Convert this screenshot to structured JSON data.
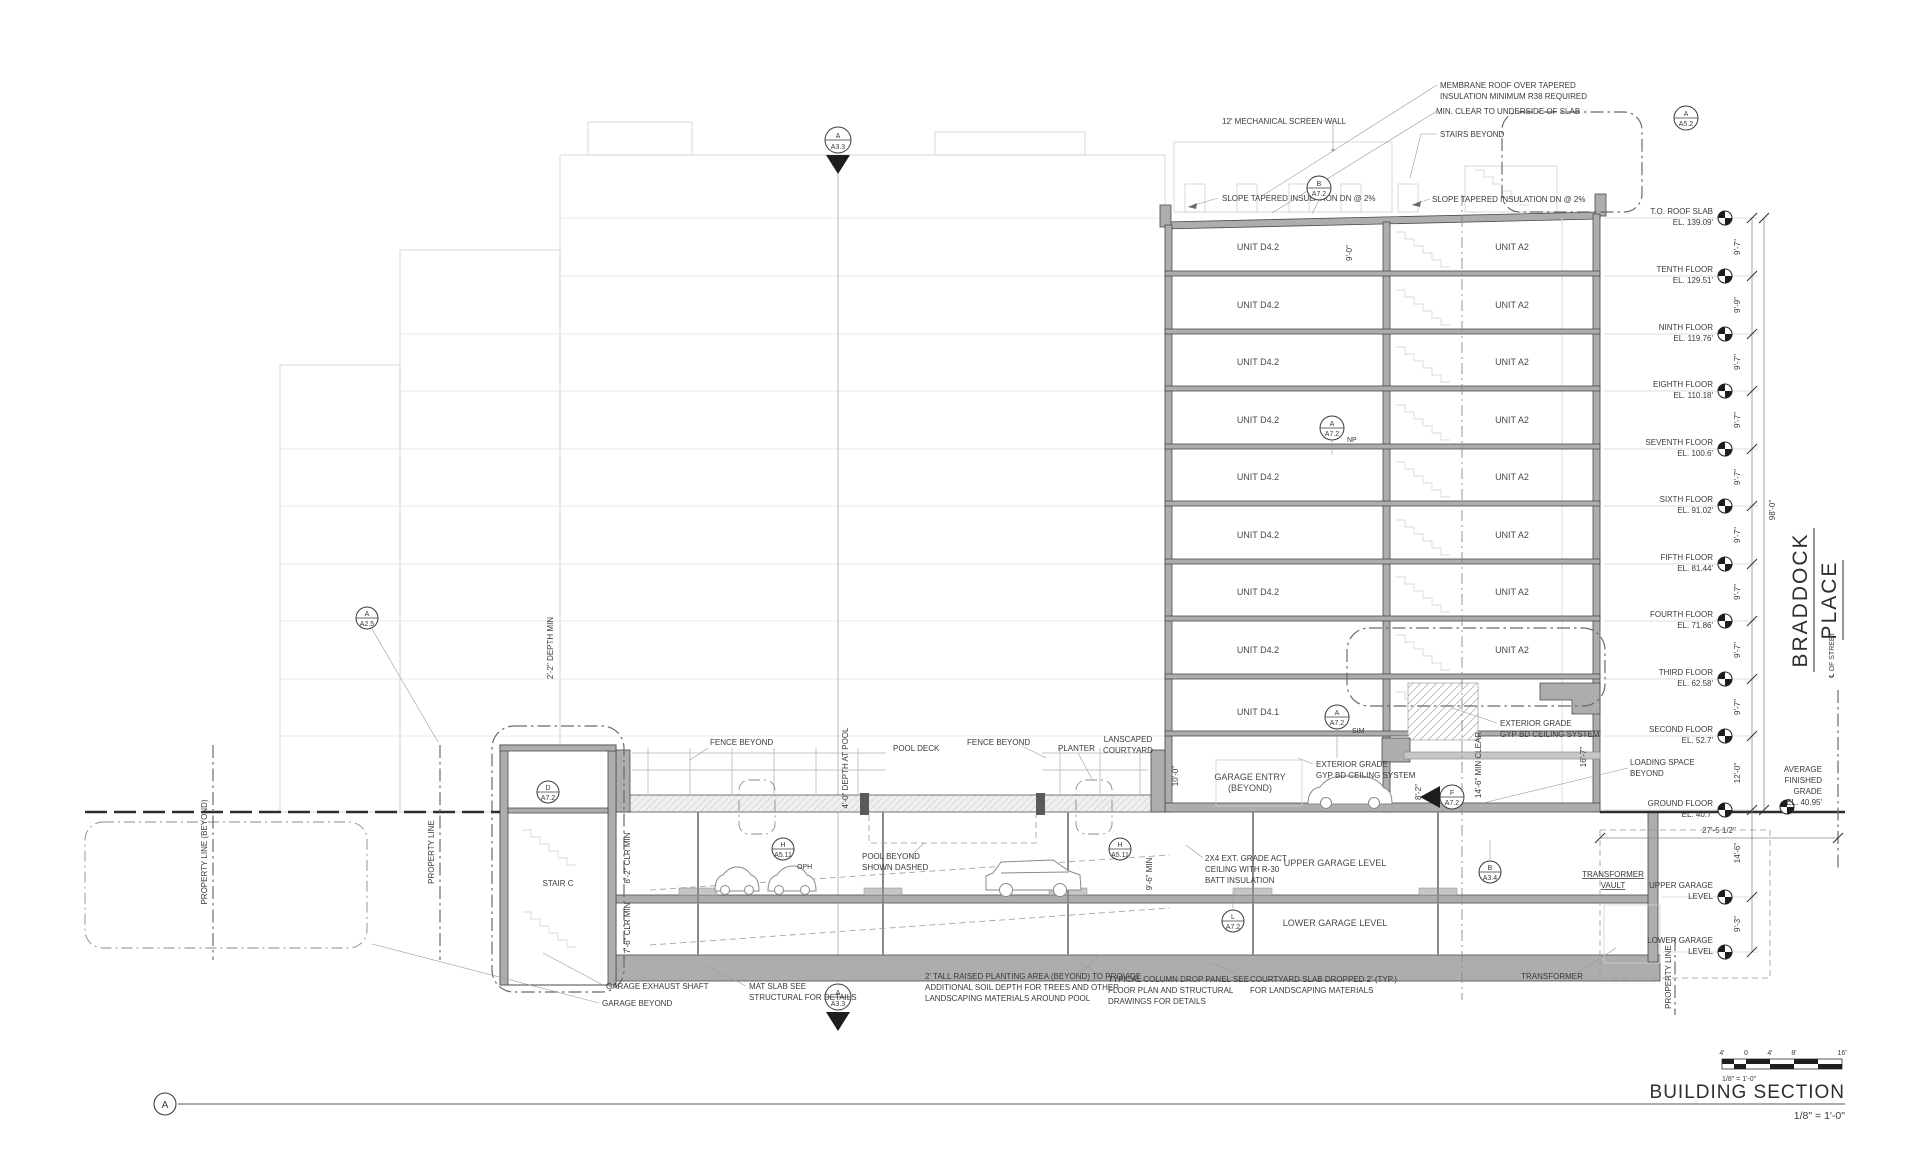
{
  "drawing": {
    "title": "BUILDING SECTION",
    "scale": "1/8\" = 1'-0\"",
    "detail_letter": "A",
    "scale_bar": {
      "m4": "4'",
      "zero": "0",
      "p4": "4'",
      "p8": "8'",
      "p16": "16'",
      "note": "1/8\" = 1'-0\""
    }
  },
  "street": {
    "braddock": "BRADDOCK",
    "place": "PLACE",
    "centerline": "℄ OF STREET"
  },
  "levels": [
    {
      "l1": "T.O. ROOF SLAB",
      "l2": "EL. 139.09'"
    },
    {
      "l1": "TENTH FLOOR",
      "l2": "EL. 129.51'"
    },
    {
      "l1": "NINTH FLOOR",
      "l2": "EL. 119.76'"
    },
    {
      "l1": "EIGHTH FLOOR",
      "l2": "EL. 110.18'"
    },
    {
      "l1": "SEVENTH FLOOR",
      "l2": "EL. 100.6'"
    },
    {
      "l1": "SIXTH FLOOR",
      "l2": "EL. 91.02'"
    },
    {
      "l1": "FIFTH FLOOR",
      "l2": "EL. 81.44'"
    },
    {
      "l1": "FOURTH FLOOR",
      "l2": "EL. 71.86'"
    },
    {
      "l1": "THIRD FLOOR",
      "l2": "EL. 62.58'"
    },
    {
      "l1": "SECOND FLOOR",
      "l2": "EL. 52.7'"
    },
    {
      "l1": "GROUND FLOOR",
      "l2": "EL. 40.7'"
    },
    {
      "l1": "UPPER GARAGE",
      "l2": "LEVEL"
    },
    {
      "l1": "LOWER GARAGE",
      "l2": "LEVEL"
    }
  ],
  "avg_grade": {
    "l1": "AVERAGE",
    "l2": "FINISHED",
    "l3": "GRADE",
    "l4": "EL. 40.95'"
  },
  "dims": {
    "stack": [
      "9'-7\"",
      "9'-9\"",
      "9'-7\"",
      "9'-7\"",
      "9'-7\"",
      "9'-7\"",
      "9'-7\"",
      "9'-7\"",
      "9'-7\"",
      "12'-0\"",
      "14'-6\"",
      "9'-3\""
    ],
    "overall": "98'-0\"",
    "street_offset": "27'-5 1/2\"",
    "roof_clear": "9'-0\"",
    "garage_clear": "9'-6\" MIN",
    "entry_height": "8'-2\"",
    "entry_clear": "14'-6\" MIN CLEAR",
    "loading_height": "16'-7\"",
    "courtyard_wall": "10'-0\"",
    "pool_depth": "4'-0\" DEPTH AT POOL",
    "planter_depth": "2'-2\" DEPTH MIN",
    "stair_clear_upper": "8'-2\" CLR MIN",
    "stair_clear_lower": "7'-6\" CLR MIN"
  },
  "units": {
    "d42": "UNIT D4.2",
    "d41": "UNIT D4.1",
    "a2": "UNIT A2"
  },
  "notes": {
    "membrane_l1": "MEMBRANE ROOF OVER TAPERED",
    "membrane_l2": "INSULATION MINIMUM R38 REQUIRED",
    "min_clear": "MIN. CLEAR TO UNDERSIDE OF SLAB",
    "screen_wall": "12' MECHANICAL SCREEN WALL",
    "stairs_beyond": "STAIRS BEYOND",
    "slope": "SLOPE TAPERED INSULATION DN @ 2%",
    "fence_beyond": "FENCE BEYOND",
    "pool_deck": "POOL DECK",
    "planter": "PLANTER",
    "landscaped_l1": "LANSCAPED",
    "landscaped_l2": "COURTYARD",
    "garage_entry_l1": "GARAGE ENTRY",
    "garage_entry_l2": "(BEYOND)",
    "ext_gyp_l1": "EXTERIOR GRADE",
    "ext_gyp_l2": "GYP BD CEILING SYSTEM",
    "loading_l1": "LOADING SPACE",
    "loading_l2": "BEYOND",
    "pool_dashed_l1": "POOL BEYOND",
    "pool_dashed_l2": "SHOWN DASHED",
    "oph": "OPH",
    "act_l1": "2X4 EXT. GRADE ACT",
    "act_l2": "CEILING WITH R-30",
    "act_l3": "BATT INSULATION",
    "upper_garage": "UPPER GARAGE LEVEL",
    "lower_garage": "LOWER GARAGE LEVEL",
    "vault_l1": "TRANSFORMER",
    "vault_l2": "VAULT",
    "transformer": "TRANSFORMER",
    "stair_c": "STAIR C",
    "property_line": "PROPERTY LINE",
    "property_line_beyond": "PROPERTY LINE (BEYOND)",
    "garage_exhaust": "GARAGE EXHAUST SHAFT",
    "garage_beyond": "GARAGE BEYOND",
    "mat_slab_l1": "MAT SLAB SEE",
    "mat_slab_l2": "STRUCTURAL FOR DETAILS",
    "planting_l1": "2' TALL RAISED PLANTING AREA (BEYOND) TO PROVIDE",
    "planting_l2": "ADDITIONAL SOIL DEPTH FOR TREES AND OTHER",
    "planting_l3": "LANDSCAPING MATERIALS AROUND POOL",
    "drop_panel_l1": "TYPICAL COLUMN DROP PANEL SEE",
    "drop_panel_l2": "FLOOR PLAN AND STRUCTURAL",
    "drop_panel_l3": "DRAWINGS FOR DETAILS",
    "courtyard_slab_l1": "COURTYARD SLAB DROPPED 2'  (TYP.)",
    "courtyard_slab_l2": "FOR LANDSCAPING MATERIALS"
  },
  "callouts": {
    "b_a72_t": "B",
    "b_a72_b": "A7.2",
    "a_a52_t": "A",
    "a_a52_b": "A5.2",
    "a_a33_t": "A",
    "a_a33_b": "A3.3",
    "a_a72_t": "A",
    "a_a72_b": "A7.2",
    "np": "NP",
    "sim": "SIM",
    "h_a511_t": "H",
    "h_a511_b": "A5.11",
    "l_a72_t": "L",
    "l_a72_b": "A7.2",
    "b_a34_t": "B",
    "b_a34_b": "A3.4",
    "f_a72_t": "F",
    "f_a72_b": "A7.2",
    "d_a72_t": "D",
    "d_a72_b": "A7.2",
    "a_a25_t": "A",
    "a_a25_b": "A2.5"
  }
}
